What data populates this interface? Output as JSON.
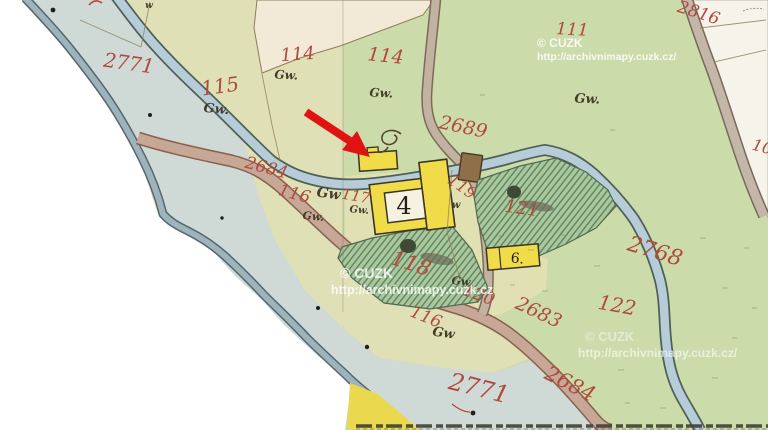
{
  "map": {
    "title": "Archival cadastral map sheet with red arrow annotation",
    "watermarks": [
      {
        "text": "© CUZK"
      },
      {
        "text": "http://archivnimapy.cuzk.cz/"
      },
      {
        "text": "© CUZK"
      },
      {
        "text": "http://archivnimapy.cuzk.cz"
      },
      {
        "text": "© CUZK"
      },
      {
        "text": "http://archivnimapy.cuzk.cz/"
      }
    ],
    "text_labels": [
      {
        "t": "2771",
        "x": 128,
        "y": 70,
        "s": 20,
        "r": 8,
        "cls": "red",
        "n": "parcel-number-2771"
      },
      {
        "t": "115",
        "x": 221,
        "y": 93,
        "s": 20,
        "r": -8,
        "cls": "red",
        "n": "parcel-number-115"
      },
      {
        "t": "114",
        "x": 298,
        "y": 60,
        "s": 18,
        "r": -4,
        "cls": "red",
        "n": "parcel-number-114"
      },
      {
        "t": "114",
        "x": 385,
        "y": 62,
        "s": 19,
        "r": 6,
        "cls": "red",
        "n": "parcel-number-114"
      },
      {
        "t": "111",
        "x": 572,
        "y": 35,
        "s": 17,
        "r": 3,
        "cls": "red",
        "n": "parcel-number-111"
      },
      {
        "t": "2816",
        "x": 697,
        "y": 18,
        "s": 17,
        "r": 18,
        "cls": "red",
        "n": "parcel-number-2816"
      },
      {
        "t": "10",
        "x": 761,
        "y": 152,
        "s": 16,
        "r": 15,
        "cls": "red",
        "n": "parcel-number-10-clipped"
      },
      {
        "t": "2689",
        "x": 462,
        "y": 133,
        "s": 19,
        "r": 12,
        "cls": "red",
        "n": "parcel-number-2689"
      },
      {
        "t": "2684",
        "x": 265,
        "y": 173,
        "s": 17,
        "r": 15,
        "cls": "red",
        "n": "parcel-number-2684"
      },
      {
        "t": "116",
        "x": 293,
        "y": 199,
        "s": 17,
        "r": 15,
        "cls": "red",
        "n": "parcel-number-116"
      },
      {
        "t": "117",
        "x": 355,
        "y": 201,
        "s": 15,
        "r": 10,
        "cls": "red",
        "n": "parcel-number-117"
      },
      {
        "t": "119",
        "x": 459,
        "y": 191,
        "s": 16,
        "r": 35,
        "cls": "red",
        "n": "parcel-number-119"
      },
      {
        "t": "118",
        "x": 409,
        "y": 270,
        "s": 21,
        "r": 18,
        "col": "#b84f3f",
        "cls": "red",
        "n": "parcel-number-118"
      },
      {
        "t": "121",
        "x": 521,
        "y": 214,
        "s": 18,
        "r": 8,
        "col": "#a84a3a",
        "cls": "red",
        "n": "parcel-number-121"
      },
      {
        "t": "120",
        "x": 477,
        "y": 300,
        "s": 17,
        "r": 20,
        "col": "#c05f4a",
        "cls": "red",
        "n": "parcel-number-120"
      },
      {
        "t": "116",
        "x": 424,
        "y": 322,
        "s": 17,
        "r": 22,
        "cls": "red",
        "n": "parcel-number-116"
      },
      {
        "t": "2683",
        "x": 536,
        "y": 318,
        "s": 19,
        "r": 25,
        "col": "#bc5f4a",
        "cls": "red",
        "n": "parcel-number-2683"
      },
      {
        "t": "2684",
        "x": 567,
        "y": 390,
        "s": 21,
        "r": 27,
        "col": "#c56a50",
        "cls": "red",
        "n": "parcel-number-2684"
      },
      {
        "t": "2771",
        "x": 477,
        "y": 396,
        "s": 24,
        "r": 14,
        "cls": "red",
        "n": "parcel-number-2771"
      },
      {
        "t": "2768",
        "x": 653,
        "y": 258,
        "s": 22,
        "r": 17,
        "col": "#c8705a",
        "cls": "red",
        "n": "parcel-number-2768"
      },
      {
        "t": "122",
        "x": 616,
        "y": 312,
        "s": 20,
        "r": 10,
        "cls": "red",
        "n": "parcel-number-122"
      },
      {
        "t": "4",
        "x": 404,
        "y": 214,
        "s": 24,
        "r": 0,
        "cls": "blk",
        "n": "building-number-4"
      },
      {
        "t": "6.",
        "x": 517,
        "y": 263,
        "s": 14,
        "r": 5,
        "cls": "blk",
        "n": "building-number-6"
      },
      {
        "t": "Gw.",
        "x": 216,
        "y": 113,
        "s": 13,
        "r": 5,
        "cls": "lu",
        "n": "landuse-mark"
      },
      {
        "t": "Gw.",
        "x": 286,
        "y": 79,
        "s": 12,
        "r": 3,
        "cls": "lu",
        "n": "landuse-mark"
      },
      {
        "t": "Gw.",
        "x": 381,
        "y": 97,
        "s": 12,
        "r": 3,
        "cls": "lu",
        "n": "landuse-mark"
      },
      {
        "t": "Gw.",
        "x": 587,
        "y": 103,
        "s": 13,
        "r": 3,
        "cls": "lu",
        "n": "landuse-mark"
      },
      {
        "t": "Gw",
        "x": 328,
        "y": 198,
        "s": 14,
        "r": 8,
        "cls": "lu",
        "n": "landuse-mark"
      },
      {
        "t": "Gw.",
        "x": 359,
        "y": 213,
        "s": 10,
        "r": 5,
        "cls": "lu",
        "n": "landuse-mark"
      },
      {
        "t": "Gw.",
        "x": 313,
        "y": 220,
        "s": 11,
        "r": 5,
        "cls": "lu",
        "n": "landuse-mark"
      },
      {
        "t": "Gw",
        "x": 443,
        "y": 337,
        "s": 13,
        "r": 8,
        "cls": "lu",
        "n": "landuse-mark"
      },
      {
        "t": "Gw.",
        "x": 462,
        "y": 285,
        "s": 11,
        "r": 5,
        "cls": "lu",
        "n": "landuse-mark"
      },
      {
        "t": "w",
        "x": 456,
        "y": 208,
        "s": 10,
        "r": 0,
        "cls": "lu",
        "n": "landuse-mark"
      },
      {
        "t": "w",
        "x": 149,
        "y": 8,
        "s": 9,
        "r": 0,
        "cls": "lu",
        "n": "landuse-mark"
      }
    ],
    "colors": {
      "sheet_left": "#dfe0b5",
      "sheet_right": "#ccdbaa",
      "floodplain": "#cfdad7",
      "stream": "#b6cdd9",
      "road": "#c7a795",
      "building_yellow": "#f0dc48",
      "garden_green": "#a9c89b",
      "cream_field": "#f2ead6",
      "parcel_number_red": "#b04a3c",
      "annotation_arrow": "#e01212",
      "watermark": "#ffffff"
    }
  }
}
